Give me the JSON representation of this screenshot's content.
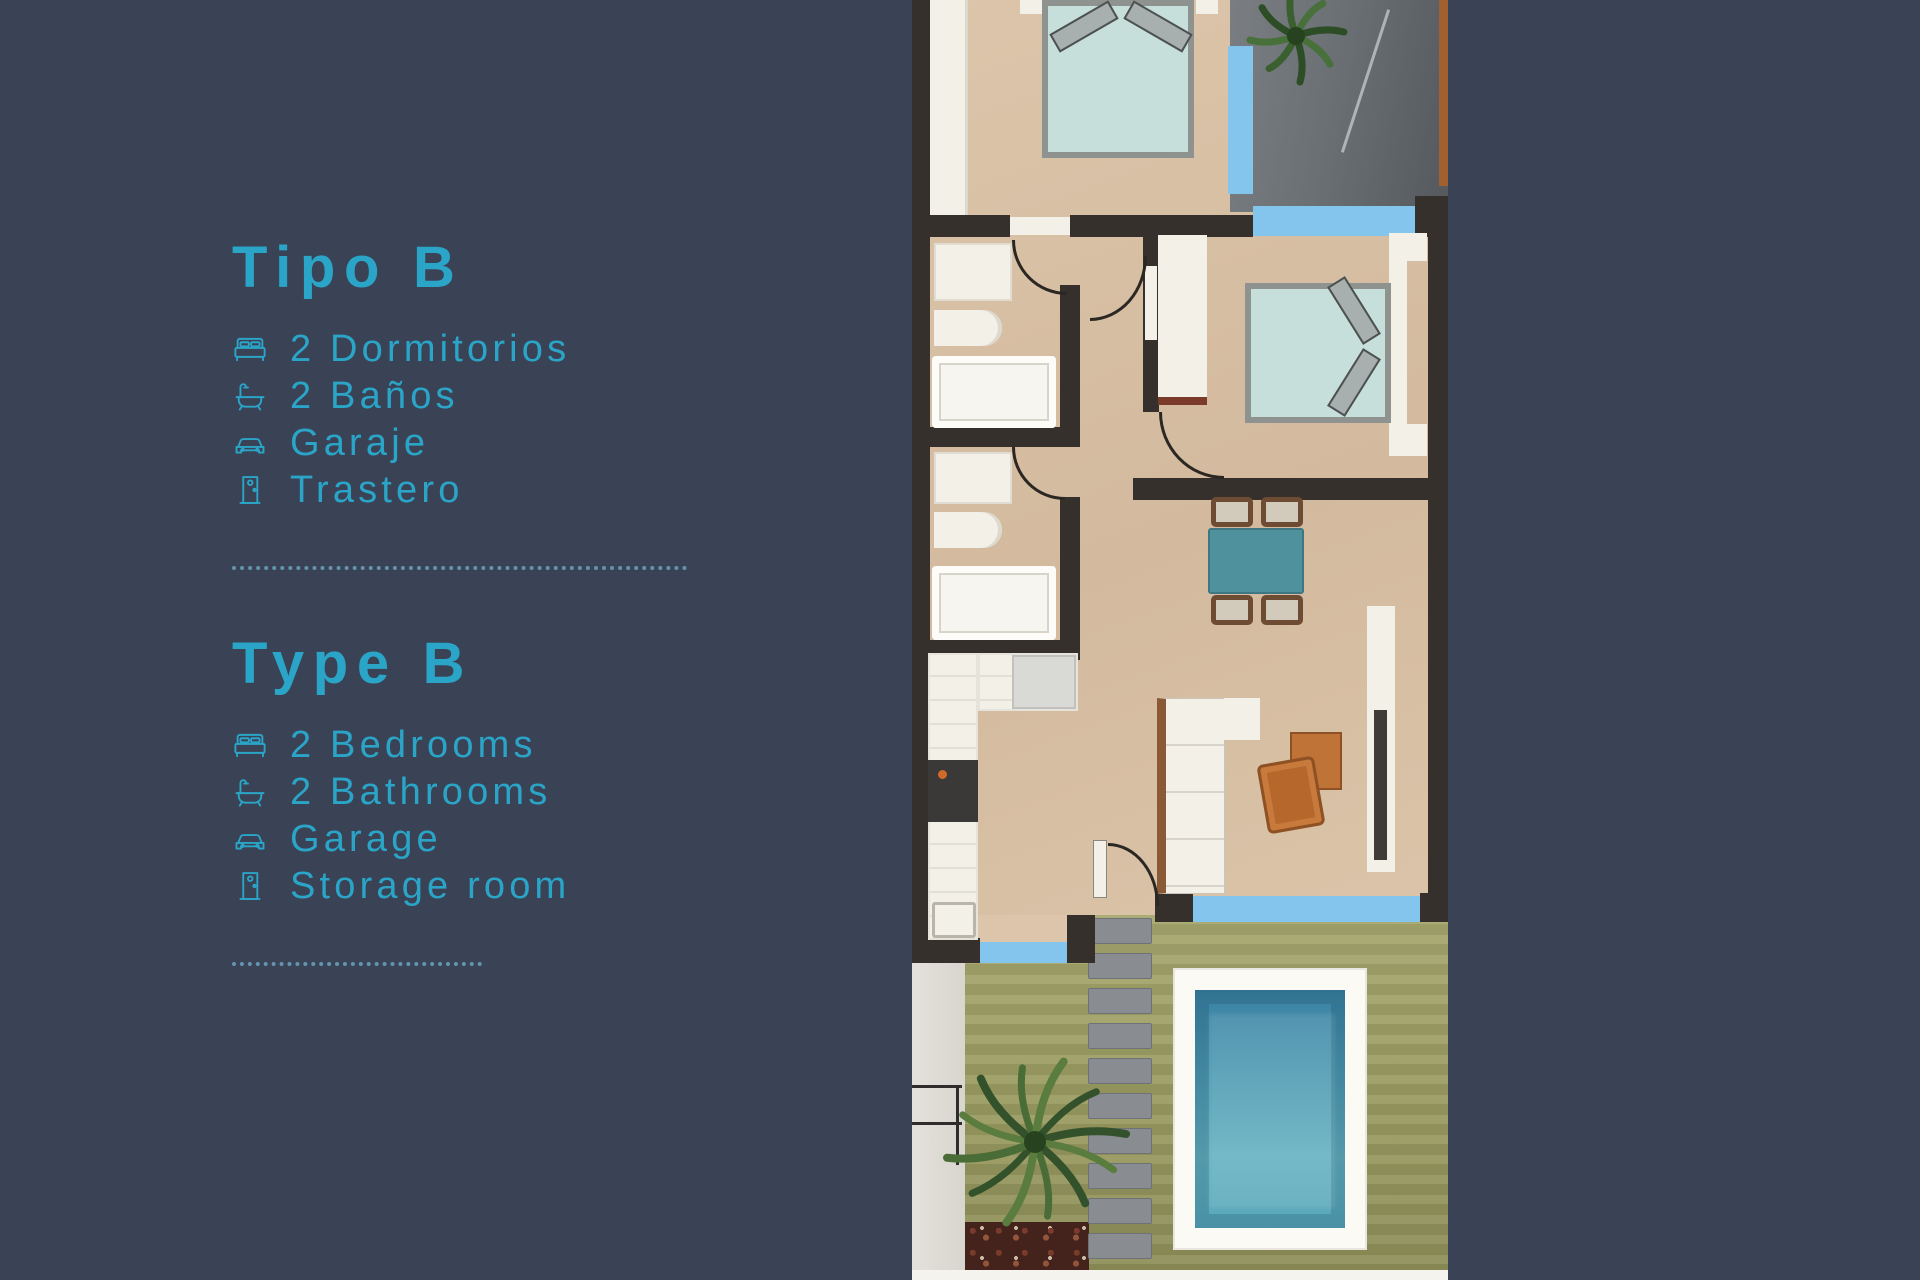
{
  "panel": {
    "es": {
      "title": "Tipo B",
      "items": [
        {
          "icon": "bed-icon",
          "label": "2 Dormitorios"
        },
        {
          "icon": "bath-icon",
          "label": "2 Baños"
        },
        {
          "icon": "car-icon",
          "label": "Garaje"
        },
        {
          "icon": "door-icon",
          "label": "Trastero"
        }
      ]
    },
    "en": {
      "title": "Type B",
      "items": [
        {
          "icon": "bed-icon",
          "label": "2 Bedrooms"
        },
        {
          "icon": "bath-icon",
          "label": "2 Bathrooms"
        },
        {
          "icon": "car-icon",
          "label": "Garage"
        },
        {
          "icon": "door-icon",
          "label": "Storage room"
        }
      ]
    }
  },
  "colors": {
    "background": "#3a4255",
    "accent": "#2aa5c8",
    "separator": "#6fa9c4",
    "wall": "#35302b",
    "floor": "#dcc5aa",
    "window": "#84c5ee",
    "fixture-white": "#f3f0e8",
    "bed": "#c6dfdb",
    "bed-frame": "#8e938f",
    "pillow": "#a7b0ae",
    "table-teal": "#4f919c",
    "wood": "#8a5a36",
    "orange": "#c07336",
    "cabinet-slot": "#3f3b37",
    "stove": "#3b3937",
    "lawn": "#9b9c62",
    "mulch": "#45231d",
    "paver": "#898d92",
    "walkway": "#d8d5ce",
    "pool-frame": "#fbfaf5",
    "pool-deep": "#3a81a3",
    "pool-light": "#64b1c1",
    "plant-dark": "#33512b",
    "plant-light": "#5a7d3f",
    "door-brown": "#a3602f",
    "rail": "#2e2d2b"
  }
}
